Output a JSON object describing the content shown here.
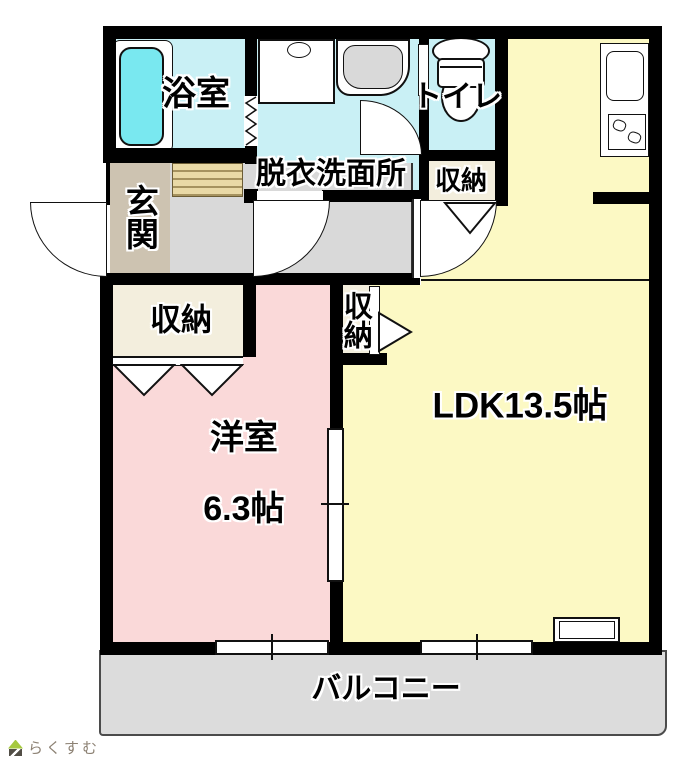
{
  "labels": {
    "bathroom": "浴室",
    "washroom": "脱衣洗面所",
    "toilet": "トイレ",
    "storage_toilet": "収納",
    "entrance": "玄関",
    "storage_west": "収納",
    "storage_hall": "収納",
    "western_room": "洋室",
    "western_room_size": "6.3帖",
    "ldk": "LDK13.5帖",
    "balcony": "バルコニー"
  },
  "logo": {
    "text": "らくすむ"
  },
  "colors": {
    "wall": "#000000",
    "wet_area_floor": "#c9f0f5",
    "bathtub": "#79e8f0",
    "entrance_floor": "#cdc3b1",
    "entrance_step": "#e9d9a6",
    "hallway_floor": "#d9d9d9",
    "storage_floor": "#f3eedd",
    "western_room_floor": "#fad9d9",
    "ldk_floor": "#fcf9c4",
    "balcony_floor": "#dcdcdc",
    "logo_green": "#a6c93f",
    "logo_dark": "#524e46",
    "logo_text_color": "#8c8173"
  }
}
